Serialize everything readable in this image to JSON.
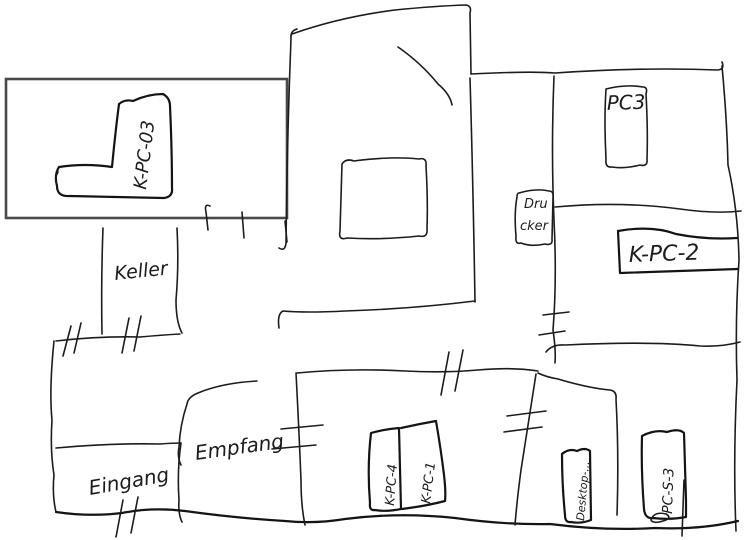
{
  "floor_plan": {
    "colors": {
      "ink": "#1c1c1c",
      "frame": "#4a4a4a",
      "background": "#ffffff"
    },
    "rooms": [
      {
        "id": "keller",
        "label": "Keller"
      },
      {
        "id": "eingang",
        "label": "Eingang"
      },
      {
        "id": "empfang",
        "label": "Empfang"
      }
    ],
    "equipment": [
      {
        "id": "k-pc-03",
        "label": "K-PC-03"
      },
      {
        "id": "pc3",
        "label": "PC3"
      },
      {
        "id": "drucker",
        "label_lines": [
          "Dru",
          "cker"
        ]
      },
      {
        "id": "k-pc-2",
        "label": "K-PC-2"
      },
      {
        "id": "k-pc-4",
        "label": "K-PC-4"
      },
      {
        "id": "k-pc-1",
        "label": "K-PC-1"
      },
      {
        "id": "desktop",
        "label": "Desktop-..."
      },
      {
        "id": "pc-s-3",
        "label": "PC-S-3"
      }
    ]
  }
}
